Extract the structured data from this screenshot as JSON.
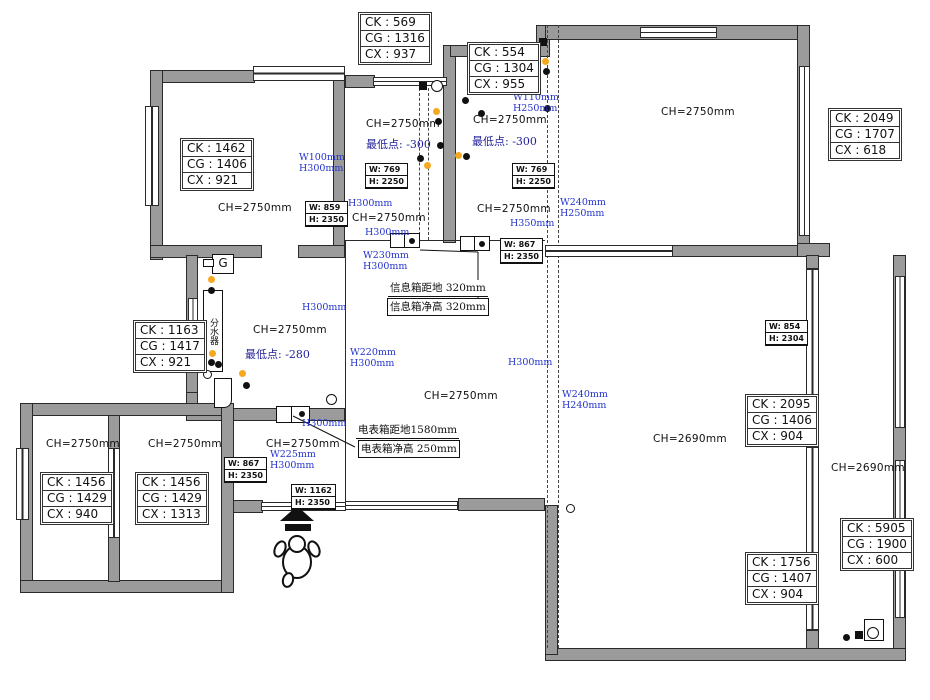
{
  "colors": {
    "wall": "#9b9b9b",
    "blue": "#2433cc",
    "navy": "#1f1f99",
    "orange": "#f6a820"
  },
  "dimension_boxes": [
    {
      "x": 358,
      "y": 12,
      "rows": [
        "CK : 569",
        "CG : 1316",
        "CX : 937"
      ]
    },
    {
      "x": 467,
      "y": 42,
      "rows": [
        "CK : 554",
        "CG : 1304",
        "CX : 955"
      ]
    },
    {
      "x": 828,
      "y": 108,
      "rows": [
        "CK : 2049",
        "CG : 1707",
        "CX : 618"
      ]
    },
    {
      "x": 180,
      "y": 138,
      "rows": [
        "CK : 1462",
        "CG : 1406",
        "CX : 921"
      ]
    },
    {
      "x": 133,
      "y": 320,
      "rows": [
        "CK : 1163",
        "CG : 1417",
        "CX : 921"
      ]
    },
    {
      "x": 40,
      "y": 472,
      "rows": [
        "CK : 1456",
        "CG : 1429",
        "CX : 940"
      ]
    },
    {
      "x": 135,
      "y": 472,
      "rows": [
        "CK : 1456",
        "CG : 1429",
        "CX : 1313"
      ]
    },
    {
      "x": 745,
      "y": 394,
      "rows": [
        "CK : 2095",
        "CG : 1406",
        "CX : 904"
      ]
    },
    {
      "x": 745,
      "y": 552,
      "rows": [
        "CK : 1756",
        "CG : 1407",
        "CX : 904"
      ]
    },
    {
      "x": 840,
      "y": 518,
      "rows": [
        "CK : 5905",
        "CG : 1900",
        "CX : 600"
      ]
    }
  ],
  "door_size_boxes": [
    {
      "x": 365,
      "y": 163,
      "rows": [
        "W: 769",
        "H: 2250"
      ]
    },
    {
      "x": 512,
      "y": 163,
      "rows": [
        "W: 769",
        "H: 2250"
      ]
    },
    {
      "x": 305,
      "y": 201,
      "rows": [
        "W: 859",
        "H: 2350"
      ]
    },
    {
      "x": 500,
      "y": 238,
      "rows": [
        "W: 867",
        "H: 2350"
      ]
    },
    {
      "x": 765,
      "y": 320,
      "rows": [
        "W: 854",
        "H: 2304"
      ]
    },
    {
      "x": 224,
      "y": 457,
      "rows": [
        "W: 867",
        "H: 2350"
      ]
    },
    {
      "x": 291,
      "y": 484,
      "rows": [
        "W: 1162",
        "H: 2350"
      ]
    }
  ],
  "ceiling_height_labels": [
    {
      "x": 218,
      "y": 202,
      "text": "CH=2750mm"
    },
    {
      "x": 366,
      "y": 118,
      "text": "CH=2750mm"
    },
    {
      "x": 473,
      "y": 114,
      "text": "CH=2750mm"
    },
    {
      "x": 661,
      "y": 106,
      "text": "CH=2750mm"
    },
    {
      "x": 352,
      "y": 212,
      "text": "CH=2750mm"
    },
    {
      "x": 477,
      "y": 203,
      "text": "CH=2750mm"
    },
    {
      "x": 253,
      "y": 324,
      "text": "CH=2750mm"
    },
    {
      "x": 424,
      "y": 390,
      "text": "CH=2750mm"
    },
    {
      "x": 46,
      "y": 438,
      "text": "CH=2750mm"
    },
    {
      "x": 148,
      "y": 438,
      "text": "CH=2750mm"
    },
    {
      "x": 266,
      "y": 438,
      "text": "CH=2750mm"
    },
    {
      "x": 653,
      "y": 433,
      "text": "CH=2690mm"
    },
    {
      "x": 831,
      "y": 462,
      "text": "CH=2690mm"
    }
  ],
  "lowest_point_labels": [
    {
      "x": 366,
      "y": 136,
      "text": "最低点: -300"
    },
    {
      "x": 472,
      "y": 133,
      "text": "最低点: -300"
    },
    {
      "x": 245,
      "y": 346,
      "text": "最低点: -280"
    }
  ],
  "blue_dimension_labels": [
    {
      "x": 299,
      "y": 152,
      "lines": [
        "W100mm",
        "H300mm"
      ]
    },
    {
      "x": 513,
      "y": 92,
      "lines": [
        "W110mm",
        "H250mm"
      ]
    },
    {
      "x": 348,
      "y": 198,
      "lines": [
        "H300mm"
      ]
    },
    {
      "x": 365,
      "y": 227,
      "lines": [
        "H300mm"
      ]
    },
    {
      "x": 560,
      "y": 197,
      "lines": [
        "W240mm",
        "H250mm"
      ]
    },
    {
      "x": 510,
      "y": 218,
      "lines": [
        "H350mm"
      ]
    },
    {
      "x": 363,
      "y": 250,
      "lines": [
        "W230mm",
        "H300mm"
      ]
    },
    {
      "x": 302,
      "y": 302,
      "lines": [
        "H300mm"
      ]
    },
    {
      "x": 350,
      "y": 347,
      "lines": [
        "W220mm",
        "H300mm"
      ]
    },
    {
      "x": 508,
      "y": 357,
      "lines": [
        "H300mm"
      ]
    },
    {
      "x": 562,
      "y": 389,
      "lines": [
        "W240mm",
        "H240mm"
      ]
    },
    {
      "x": 302,
      "y": 418,
      "lines": [
        "H300mm"
      ]
    },
    {
      "x": 270,
      "y": 449,
      "lines": [
        "W225mm",
        "H300mm"
      ]
    }
  ],
  "annotation_notes": [
    {
      "x": 388,
      "y": 280,
      "text": "信息箱距地 320mm",
      "boxed": false
    },
    {
      "x": 387,
      "y": 298,
      "text": "信息箱净高 320mm",
      "boxed": true
    },
    {
      "x": 356,
      "y": 422,
      "text": "电表箱距地1580mm",
      "boxed": false
    },
    {
      "x": 358,
      "y": 440,
      "text": "电表箱净高 250mm",
      "boxed": true
    }
  ],
  "fixture_labels": {
    "manifold": "分水器",
    "switch": "G"
  }
}
